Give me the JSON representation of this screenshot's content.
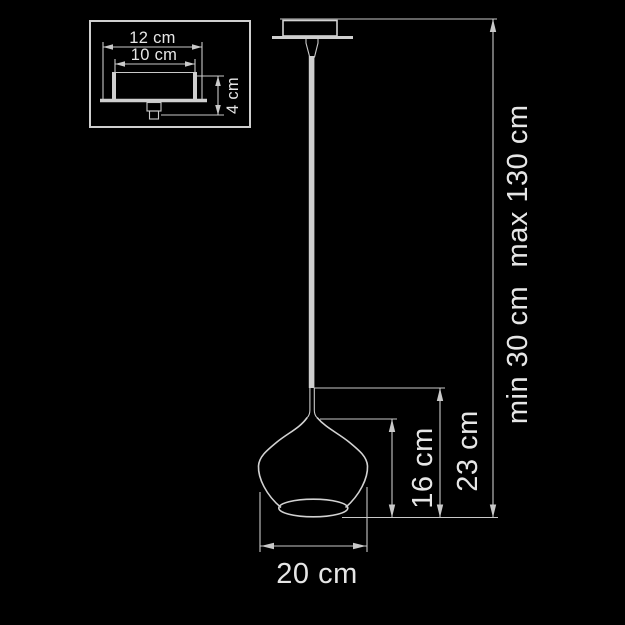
{
  "drawing_type": "pendant-lamp-dimension-diagram",
  "colors": {
    "background": "#000000",
    "line": "#c9c9c9",
    "text": "#e6e6e6",
    "cord_fill": "#cfcfcf"
  },
  "inset": {
    "labels": {
      "outer_width": "12 cm",
      "inner_width": "10 cm",
      "height": "4 cm"
    }
  },
  "main": {
    "labels": {
      "shade_height": "16 cm",
      "fixture_height": "23 cm",
      "suspension_min": "min 30 cm",
      "suspension_max": "max 130 cm",
      "shade_diameter": "20 cm"
    }
  }
}
